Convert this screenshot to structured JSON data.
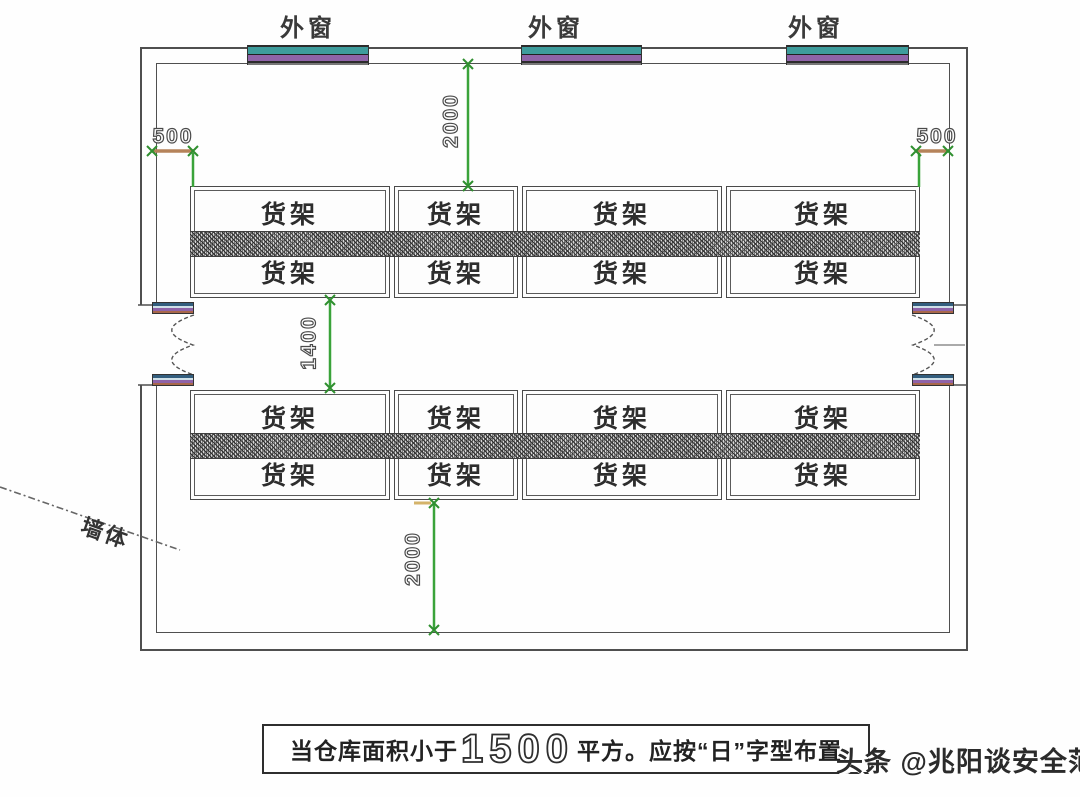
{
  "plan": {
    "windows": [
      {
        "label": "外窗"
      },
      {
        "label": "外窗"
      },
      {
        "label": "外窗"
      }
    ],
    "wall_label": "墙体",
    "dimensions": {
      "left_offset": "500",
      "right_offset": "500",
      "top_clearance": "2000",
      "aisle_width": "1400",
      "bottom_clearance": "2000"
    },
    "rows": [
      {
        "blocks": [
          {
            "top": "货架",
            "bottom": "货架"
          },
          {
            "top": "货架",
            "bottom": "货架"
          },
          {
            "top": "货架",
            "bottom": "货架"
          },
          {
            "top": "货架",
            "bottom": "货架"
          }
        ]
      },
      {
        "blocks": [
          {
            "top": "货架",
            "bottom": "货架"
          },
          {
            "top": "货架",
            "bottom": "货架"
          },
          {
            "top": "货架",
            "bottom": "货架"
          },
          {
            "top": "货架",
            "bottom": "货架"
          }
        ]
      }
    ]
  },
  "caption": {
    "prefix": "当仓库面积小于",
    "area_value": "1500",
    "suffix": "平方。应按“日”字型布置"
  },
  "watermark": "头条 @兆阳谈安全范",
  "colors": {
    "dimension_green": "#3aa33a",
    "offset_brown": "#b5835a",
    "window_teal": "#3e9c9c",
    "window_purple": "#8f63a8",
    "jamb_brown": "#a8674b",
    "line_gray": "#4f4f4f",
    "watermark_gray": "#2b2b2b"
  }
}
